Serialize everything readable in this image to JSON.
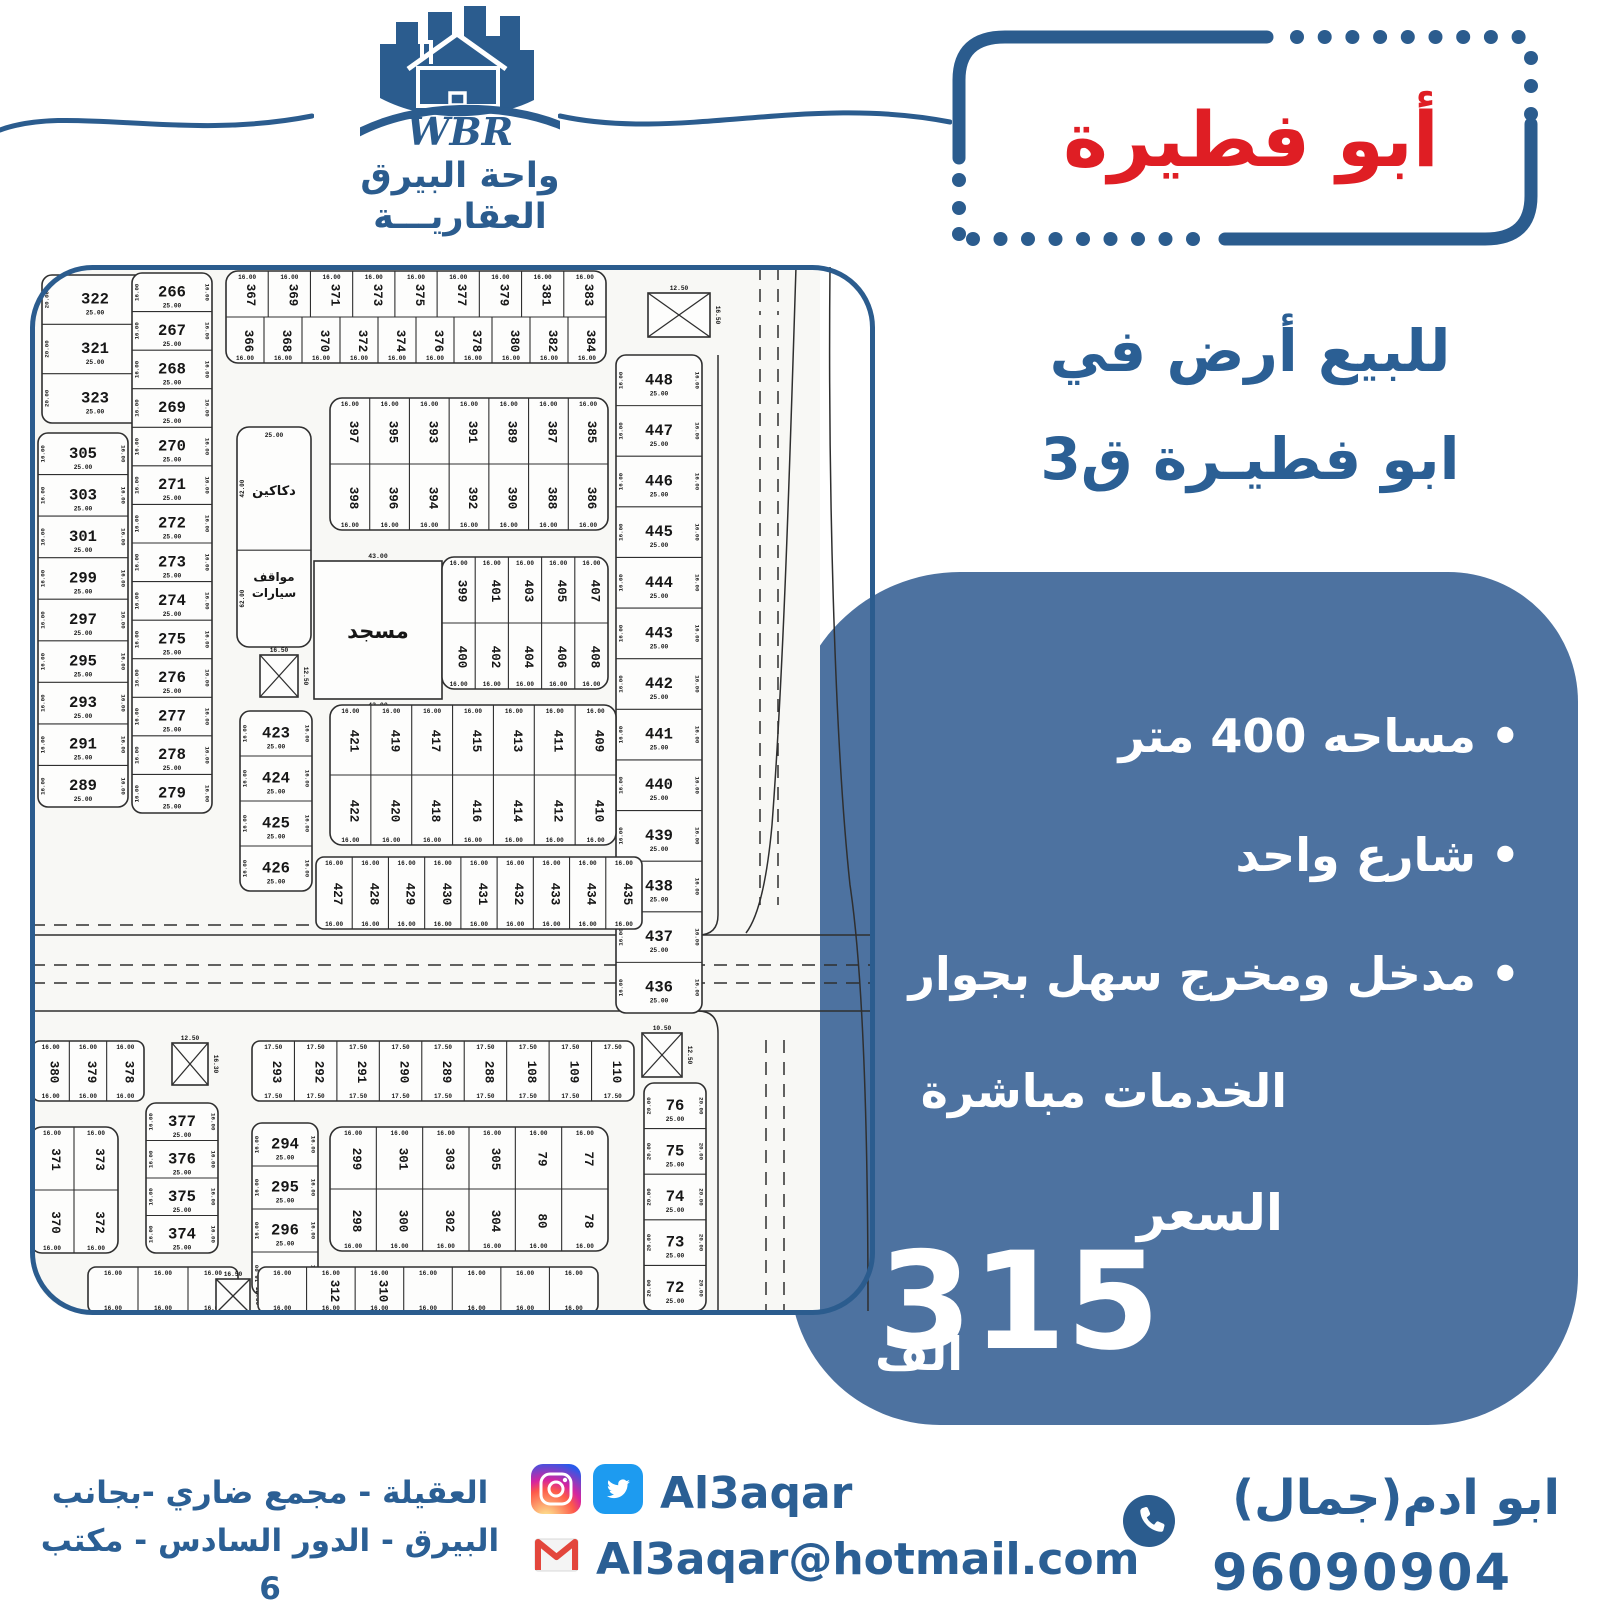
{
  "colors": {
    "blue_dark": "#2b5c8e",
    "blue_text": "#2b5f94",
    "box_blue": "#4d72a0",
    "red": "#df1e24",
    "twitter_blue": "#1d9bf0",
    "gmail_red": "#e3463c",
    "map_line": "#2f2f2f",
    "map_bg": "#f8f8f5"
  },
  "logo": {
    "wbr": "WBR",
    "name_line1": "واحة البيرق",
    "name_line2": "العقاريـــة"
  },
  "title": {
    "text": "أبو فطيرة"
  },
  "subtitle": {
    "line1": "للبيع أرض في",
    "line2": "ابو فطيـرة ق3"
  },
  "offer": {
    "bullets": [
      "مساحه 400 متر",
      "شارع واحد",
      "مدخل ومخرج سهل بجوار"
    ],
    "continuation": "الخدمات مباشرة",
    "price_label": "السعر",
    "price_value": "315",
    "price_unit": "الف"
  },
  "footer": {
    "address_line1": "العقيلة - مجمع ضاري -بجانب",
    "address_line2": "البيرق - الدور السادس - مكتب 6",
    "social_handle": "Al3aqar",
    "email": "Al3aqar@hotmail.com",
    "agent": "ابو ادم(جمال)",
    "phone": "96090904"
  },
  "map": {
    "labels": {
      "shops": "دكاكين",
      "parking1": "مواقف",
      "parking2": "سيارات",
      "mosque": "مسجد"
    },
    "common_dims": [
      "25.00",
      "16.00",
      "17.50",
      "20.00",
      "21.00",
      "13.00",
      "15.00",
      "12.50",
      "16.50",
      "43.00"
    ],
    "blocks": [
      {
        "t": "col",
        "x": 12,
        "y": 10,
        "w": 106,
        "h": 148,
        "p": [
          "322",
          "321",
          "323"
        ],
        "d1": "20.00",
        "d2": "25.00"
      },
      {
        "t": "col",
        "x": 8,
        "y": 168,
        "w": 90,
        "h": 374,
        "p": [
          "305",
          "303",
          "301",
          "299",
          "297",
          "295",
          "293",
          "291",
          "289"
        ],
        "d1": "16.00",
        "d2": "25.00"
      },
      {
        "t": "col",
        "x": 102,
        "y": 8,
        "w": 80,
        "h": 540,
        "p": [
          "266",
          "267",
          "268",
          "269",
          "270",
          "271",
          "272",
          "273",
          "274",
          "275",
          "276",
          "277",
          "278",
          "279"
        ],
        "d1": "16.00",
        "d2": "25.00"
      },
      {
        "t": "grid",
        "x": 196,
        "y": 6,
        "w": 380,
        "h": 92,
        "rows": [
          [
            "367",
            "369",
            "371",
            "373",
            "375",
            "377",
            "379",
            "381",
            "383"
          ],
          [
            "366",
            "368",
            "370",
            "372",
            "374",
            "376",
            "378",
            "380",
            "382",
            "384"
          ]
        ],
        "d1": "16.00"
      },
      {
        "t": "xbox",
        "x": 618,
        "y": 28,
        "w": 62,
        "h": 44,
        "d1": "12.50",
        "d2": "16.50"
      },
      {
        "t": "col",
        "x": 586,
        "y": 90,
        "w": 86,
        "h": 658,
        "p": [
          "448",
          "447",
          "446",
          "445",
          "444",
          "443",
          "442",
          "441",
          "440",
          "439",
          "438",
          "437",
          "436"
        ],
        "d1": "16.00",
        "d2": "25.00"
      },
      {
        "t": "shops",
        "x": 207,
        "y": 162,
        "w": 74,
        "h": 220,
        "d1": "25.00",
        "d2": "42.00"
      },
      {
        "t": "xbox",
        "x": 230,
        "y": 390,
        "w": 38,
        "h": 42,
        "d1": "16.50",
        "d2": "12.50"
      },
      {
        "t": "mosque",
        "x": 284,
        "y": 296,
        "w": 128,
        "h": 138,
        "d1": "43.00",
        "d2": "47.00"
      },
      {
        "t": "grid",
        "x": 300,
        "y": 133,
        "w": 278,
        "h": 132,
        "rows": [
          [
            "397",
            "395",
            "393",
            "391",
            "389",
            "387",
            "385"
          ],
          [
            "398",
            "396",
            "394",
            "392",
            "390",
            "388",
            "386"
          ]
        ],
        "d1": "16.00"
      },
      {
        "t": "grid",
        "x": 412,
        "y": 292,
        "w": 166,
        "h": 132,
        "rows": [
          [
            "399",
            "401",
            "403",
            "405",
            "407"
          ],
          [
            "400",
            "402",
            "404",
            "406",
            "408"
          ]
        ],
        "d1": "16.00"
      },
      {
        "t": "col",
        "x": 210,
        "y": 446,
        "w": 72,
        "h": 180,
        "p": [
          "423",
          "424",
          "425",
          "426"
        ],
        "d1": "16.00",
        "d2": "25.00"
      },
      {
        "t": "grid",
        "x": 300,
        "y": 440,
        "w": 286,
        "h": 140,
        "rows": [
          [
            "421",
            "419",
            "417",
            "415",
            "413",
            "411",
            "409"
          ],
          [
            "422",
            "420",
            "418",
            "416",
            "414",
            "412",
            "410"
          ]
        ],
        "d1": "16.00"
      },
      {
        "t": "row",
        "x": 286,
        "y": 592,
        "w": 326,
        "h": 72,
        "p": [
          "427",
          "428",
          "429",
          "430",
          "431",
          "432",
          "433",
          "434",
          "435"
        ],
        "d1": "16.00"
      },
      {
        "t": "row",
        "x": 2,
        "y": 776,
        "w": 112,
        "h": 60,
        "p": [
          "380",
          "379",
          "378"
        ],
        "d1": "16.00"
      },
      {
        "t": "xbox",
        "x": 142,
        "y": 778,
        "w": 36,
        "h": 42,
        "d1": "12.50",
        "d2": "16.30"
      },
      {
        "t": "col",
        "x": 116,
        "y": 838,
        "w": 72,
        "h": 150,
        "p": [
          "377",
          "376",
          "375",
          "374"
        ],
        "d1": "16.00",
        "d2": "25.00"
      },
      {
        "t": "grid",
        "x": 0,
        "y": 862,
        "w": 88,
        "h": 126,
        "rows": [
          [
            "371",
            "373"
          ],
          [
            "370",
            "372"
          ]
        ],
        "d1": "16.00"
      },
      {
        "t": "row",
        "x": 222,
        "y": 776,
        "w": 382,
        "h": 60,
        "p": [
          "293",
          "292",
          "291",
          "290",
          "289",
          "288",
          "108",
          "109",
          "110"
        ],
        "d1": "17.50"
      },
      {
        "t": "xbox",
        "x": 612,
        "y": 768,
        "w": 40,
        "h": 44,
        "d1": "10.50",
        "d2": "12.50"
      },
      {
        "t": "col",
        "x": 614,
        "y": 818,
        "w": 62,
        "h": 228,
        "p": [
          "76",
          "75",
          "74",
          "73",
          "72"
        ],
        "d1": "20.00",
        "d2": "25.00"
      },
      {
        "t": "col",
        "x": 222,
        "y": 858,
        "w": 66,
        "h": 172,
        "p": [
          "294",
          "295",
          "296",
          "297"
        ],
        "d1": "16.00",
        "d2": "25.00"
      },
      {
        "t": "grid",
        "x": 300,
        "y": 862,
        "w": 278,
        "h": 124,
        "rows": [
          [
            "299",
            "301",
            "303",
            "305",
            "79",
            "77"
          ],
          [
            "298",
            "300",
            "302",
            "304",
            "80",
            "78"
          ]
        ],
        "d1": "16.00"
      },
      {
        "t": "row",
        "x": 58,
        "y": 1002,
        "w": 150,
        "h": 46,
        "p": [
          "",
          "",
          ""
        ],
        "d1": "16.00"
      },
      {
        "t": "xbox",
        "x": 186,
        "y": 1014,
        "w": 34,
        "h": 34,
        "d1": "16.50",
        "d2": "12.50"
      },
      {
        "t": "row",
        "x": 228,
        "y": 1002,
        "w": 340,
        "h": 46,
        "p": [
          "",
          "312",
          "310",
          "",
          "",
          "",
          ""
        ],
        "d1": "16.00"
      }
    ]
  }
}
